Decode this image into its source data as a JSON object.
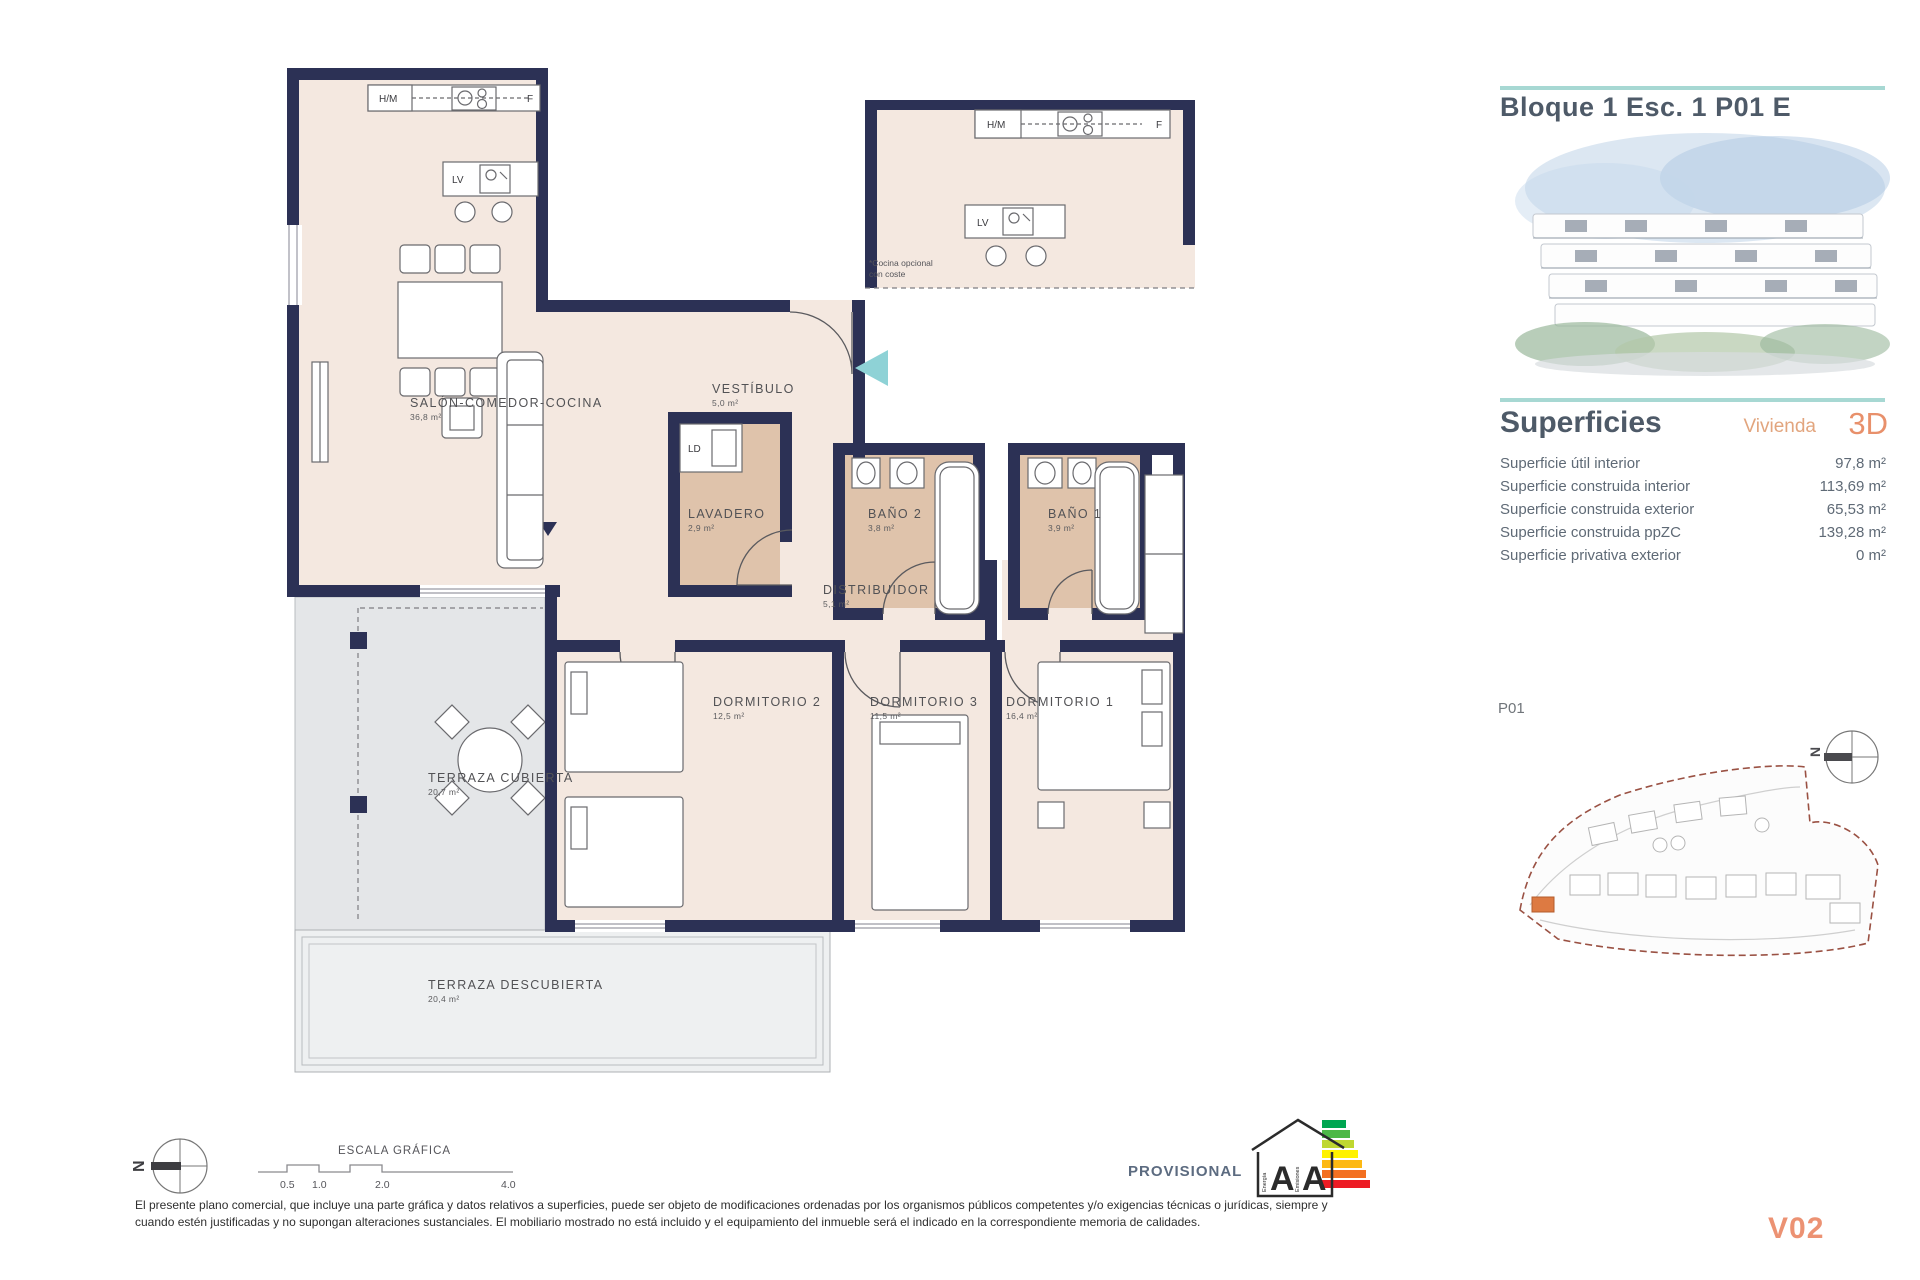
{
  "plan": {
    "rooms": {
      "salon": {
        "name": "SALÓN-COMEDOR-COCINA",
        "area": "36,8 m²"
      },
      "vestibulo": {
        "name": "VESTÍBULO",
        "area": "5,0 m²"
      },
      "lavadero": {
        "name": "LAVADERO",
        "area": "2,9 m²"
      },
      "bano2": {
        "name": "BAÑO 2",
        "area": "3,8 m²"
      },
      "bano1": {
        "name": "BAÑO 1",
        "area": "3,9 m²"
      },
      "distribuidor": {
        "name": "DISTRIBUIDOR",
        "area": "5,1 m²"
      },
      "dormitorio2": {
        "name": "DORMITORIO 2",
        "area": "12,5 m²"
      },
      "dormitorio3": {
        "name": "DORMITORIO 3",
        "area": "11,5 m²"
      },
      "dormitorio1": {
        "name": "DORMITORIO 1",
        "area": "16,4 m²"
      },
      "terraza_cubierta": {
        "name": "TERRAZA CUBIERTA",
        "area": "20,7 m²"
      },
      "terraza_descubierta": {
        "name": "TERRAZA DESCUBIERTA",
        "area": "20,4 m²"
      }
    },
    "fixtures": {
      "hm": "H/M",
      "f": "F",
      "lv": "LV",
      "ld": "LD"
    },
    "optional_kitchen_note": {
      "line1": "*Cocina opcional",
      "line2": "con coste"
    }
  },
  "sidebar": {
    "title": "Bloque 1 Esc. 1 P01 E",
    "superficies": {
      "heading": "Superficies",
      "vivienda_label": "Vivienda",
      "tipo": "3D",
      "rows": [
        {
          "label": "Superficie útil interior",
          "value": "97,8 m²"
        },
        {
          "label": "Superficie construida interior",
          "value": "113,69 m²"
        },
        {
          "label": "Superficie construida exterior",
          "value": "65,53 m²"
        },
        {
          "label": "Superficie construida ppZC",
          "value": "139,28 m²"
        },
        {
          "label": "Superficie privativa exterior",
          "value": "0 m²"
        }
      ]
    },
    "siteplan_label": "P01"
  },
  "footer": {
    "scale_title": "ESCALA GRÁFICA",
    "scale_ticks": [
      "0.5",
      "1.0",
      "2.0",
      "4.0"
    ],
    "provisional": "PROVISIONAL",
    "energy": {
      "letter1": "A",
      "letter2": "A",
      "word1": "Energía",
      "word2": "Emisiones"
    },
    "north_label": "N",
    "disclaimer_line1": "El presente plano comercial, que incluye una parte gráfica y datos relativos a superficies, puede ser objeto de modificaciones ordenadas por los organismos públicos competentes y/o exigencias técnicas o jurídicas, siempre y",
    "disclaimer_line2": "cuando estén justificadas y no supongan alteraciones sustanciales. El mobiliario mostrado no está incluido y el equipamiento del inmueble será el indicado en la correspondiente memoria de calidades.",
    "version": "V02"
  },
  "colors": {
    "wall": "#2c3155",
    "floor": "#f4e8e0",
    "wet_floor": "#dfc3ab",
    "terrace": "#e4e6e8",
    "teal_accent": "#8ed2d6",
    "teal_rule": "#a7d8d3",
    "orange": "#e8906b",
    "title_slate": "#4e5a68"
  }
}
